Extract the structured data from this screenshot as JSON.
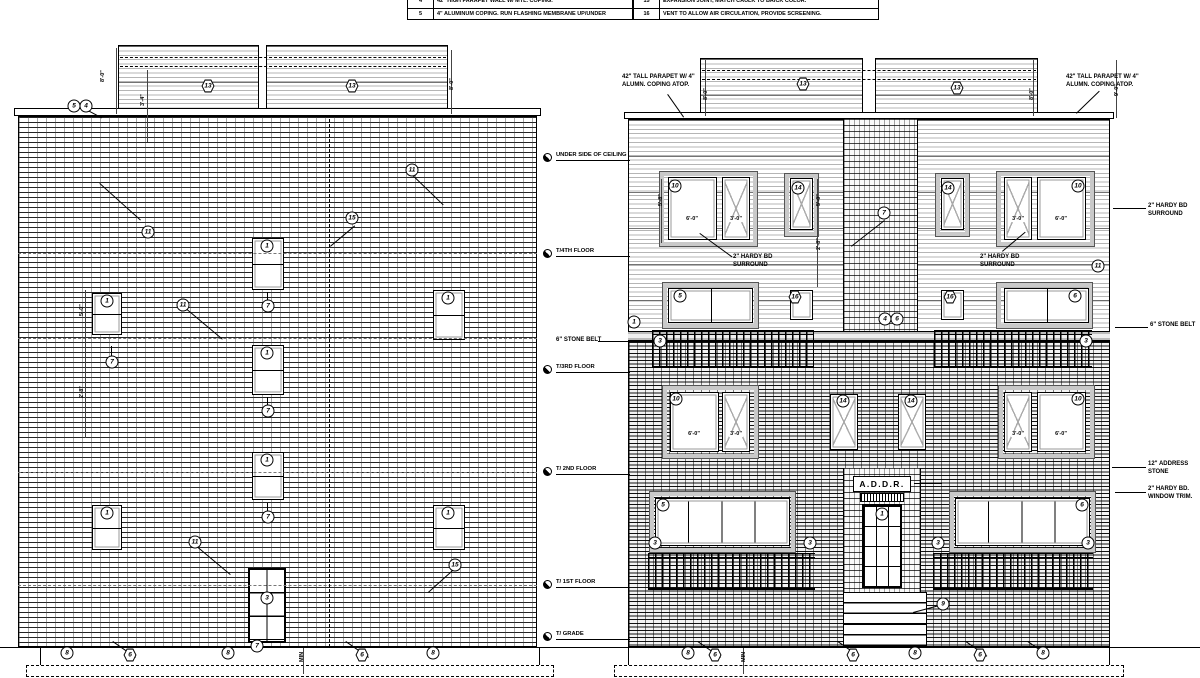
{
  "keynotes": {
    "left": [
      {
        "num": "4",
        "text": "42\" HIGH PARAPET WALL W/ MTL. COPING."
      },
      {
        "num": "5",
        "text": "4\" ALUMINUM COPING. RUN FLASHING MEMBRANE UP/UNDER"
      }
    ],
    "right": [
      {
        "num": "15",
        "text": "EXPANSION JOINT, MATCH CAULK TO BRICK COLOR."
      },
      {
        "num": "16",
        "text": "VENT TO ALLOW AIR CIRCULATION, PROVIDE SCREENING."
      }
    ]
  },
  "sign_text": "A.D.D.R.",
  "boxes": [
    {
      "cls": "siding",
      "x": 118,
      "y": 45,
      "w": 141,
      "h": 68
    },
    {
      "cls": "siding",
      "x": 266,
      "y": 45,
      "w": 182,
      "h": 68
    },
    {
      "cls": "coping",
      "x": 14,
      "y": 108,
      "w": 527,
      "h": 8
    },
    {
      "cls": "brickL",
      "x": 18,
      "y": 116,
      "w": 519,
      "h": 531
    },
    {
      "cls": "door6",
      "x": 248,
      "y": 568,
      "w": 38,
      "h": 75
    },
    {
      "cls": "found",
      "x": 40,
      "y": 647,
      "w": 500,
      "h": 18
    },
    {
      "cls": "foot",
      "x": 26,
      "y": 665,
      "w": 528,
      "h": 12
    },
    {
      "cls": "siding",
      "x": 700,
      "y": 58,
      "w": 163,
      "h": 56
    },
    {
      "cls": "siding",
      "x": 875,
      "y": 58,
      "w": 163,
      "h": 56
    },
    {
      "cls": "coping",
      "x": 624,
      "y": 112,
      "w": 490,
      "h": 7
    },
    {
      "cls": "siding",
      "x": 628,
      "y": 119,
      "w": 482,
      "h": 222
    },
    {
      "cls": "brickC",
      "x": 843,
      "y": 119,
      "w": 75,
      "h": 222
    },
    {
      "cls": "belt",
      "x": 628,
      "y": 331,
      "w": 482,
      "h": 10
    },
    {
      "cls": "brickR",
      "x": 628,
      "y": 341,
      "w": 482,
      "h": 306
    },
    {
      "cls": "surr",
      "x": 660,
      "y": 172,
      "w": 97,
      "h": 74
    },
    {
      "cls": "surr",
      "x": 997,
      "y": 172,
      "w": 97,
      "h": 74
    },
    {
      "cls": "surr",
      "x": 785,
      "y": 174,
      "w": 33,
      "h": 62
    },
    {
      "cls": "surr",
      "x": 936,
      "y": 174,
      "w": 33,
      "h": 62
    },
    {
      "cls": "surr",
      "x": 663,
      "y": 283,
      "w": 95,
      "h": 45
    },
    {
      "cls": "surr",
      "x": 997,
      "y": 283,
      "w": 95,
      "h": 45
    },
    {
      "cls": "rail",
      "x": 652,
      "y": 330,
      "w": 162,
      "h": 38
    },
    {
      "cls": "rail",
      "x": 934,
      "y": 330,
      "w": 158,
      "h": 38
    },
    {
      "cls": "surr",
      "x": 663,
      "y": 386,
      "w": 95,
      "h": 72
    },
    {
      "cls": "surr",
      "x": 999,
      "y": 386,
      "w": 95,
      "h": 72
    },
    {
      "cls": "surr",
      "x": 650,
      "y": 492,
      "w": 145,
      "h": 60
    },
    {
      "cls": "surr",
      "x": 950,
      "y": 492,
      "w": 145,
      "h": 60
    },
    {
      "cls": "brickC",
      "x": 843,
      "y": 468,
      "w": 78,
      "h": 124
    },
    {
      "cls": "signbox",
      "x": 853,
      "y": 476,
      "w": 58,
      "h": 16
    },
    {
      "cls": "vent",
      "x": 860,
      "y": 493,
      "w": 44,
      "h": 9
    },
    {
      "cls": "doorGlass",
      "x": 862,
      "y": 504,
      "w": 40,
      "h": 84
    },
    {
      "cls": "rail",
      "x": 648,
      "y": 553,
      "w": 167,
      "h": 37
    },
    {
      "cls": "rail",
      "x": 933,
      "y": 553,
      "w": 160,
      "h": 37
    },
    {
      "cls": "stairs",
      "x": 843,
      "y": 592,
      "w": 84,
      "h": 54
    },
    {
      "cls": "found",
      "x": 628,
      "y": 647,
      "w": 482,
      "h": 18
    },
    {
      "cls": "foot",
      "x": 614,
      "y": 665,
      "w": 510,
      "h": 12
    }
  ],
  "windows": [
    {
      "cls": "dh",
      "x": 92,
      "y": 293,
      "w": 30,
      "h": 42
    },
    {
      "cls": "dh",
      "x": 92,
      "y": 505,
      "w": 30,
      "h": 45
    },
    {
      "cls": "dh",
      "x": 252,
      "y": 238,
      "w": 32,
      "h": 52
    },
    {
      "cls": "dh",
      "x": 252,
      "y": 345,
      "w": 32,
      "h": 50
    },
    {
      "cls": "dh",
      "x": 252,
      "y": 452,
      "w": 32,
      "h": 48
    },
    {
      "cls": "dh",
      "x": 433,
      "y": 290,
      "w": 32,
      "h": 50
    },
    {
      "cls": "dh",
      "x": 433,
      "y": 505,
      "w": 32,
      "h": 45
    },
    {
      "cls": "fx",
      "x": 668,
      "y": 177,
      "w": 49,
      "h": 63
    },
    {
      "cls": "cs",
      "x": 722,
      "y": 177,
      "w": 28,
      "h": 63
    },
    {
      "cls": "cs",
      "x": 790,
      "y": 178,
      "w": 23,
      "h": 52
    },
    {
      "cls": "cs",
      "x": 941,
      "y": 178,
      "w": 23,
      "h": 52
    },
    {
      "cls": "cs",
      "x": 1004,
      "y": 177,
      "w": 28,
      "h": 63
    },
    {
      "cls": "fx",
      "x": 1037,
      "y": 177,
      "w": 49,
      "h": 63
    },
    {
      "cls": "t2",
      "x": 668,
      "y": 288,
      "w": 85,
      "h": 35
    },
    {
      "cls": "fx",
      "x": 790,
      "y": 290,
      "w": 23,
      "h": 30
    },
    {
      "cls": "fx",
      "x": 941,
      "y": 290,
      "w": 23,
      "h": 30
    },
    {
      "cls": "t2",
      "x": 1004,
      "y": 288,
      "w": 85,
      "h": 35
    },
    {
      "cls": "fx",
      "x": 670,
      "y": 392,
      "w": 49,
      "h": 60
    },
    {
      "cls": "cs",
      "x": 722,
      "y": 392,
      "w": 28,
      "h": 60
    },
    {
      "cls": "cs",
      "x": 830,
      "y": 394,
      "w": 28,
      "h": 56
    },
    {
      "cls": "cs",
      "x": 898,
      "y": 394,
      "w": 28,
      "h": 56
    },
    {
      "cls": "cs",
      "x": 1004,
      "y": 392,
      "w": 28,
      "h": 60
    },
    {
      "cls": "fx",
      "x": 1037,
      "y": 392,
      "w": 49,
      "h": 60
    },
    {
      "cls": "t4",
      "x": 655,
      "y": 498,
      "w": 135,
      "h": 48
    },
    {
      "cls": "t4",
      "x": 955,
      "y": 498,
      "w": 135,
      "h": 48
    }
  ],
  "tags": [
    {
      "x": 74,
      "y": 106,
      "n": "5"
    },
    {
      "x": 86,
      "y": 106,
      "n": "4"
    },
    {
      "x": 208,
      "y": 86,
      "n": "13",
      "cls": "hex"
    },
    {
      "x": 352,
      "y": 86,
      "n": "13",
      "cls": "hex"
    },
    {
      "x": 107,
      "y": 301,
      "n": "1"
    },
    {
      "x": 107,
      "y": 513,
      "n": "1"
    },
    {
      "x": 267,
      "y": 246,
      "n": "1"
    },
    {
      "x": 267,
      "y": 353,
      "n": "1"
    },
    {
      "x": 267,
      "y": 460,
      "n": "1"
    },
    {
      "x": 448,
      "y": 298,
      "n": "1"
    },
    {
      "x": 448,
      "y": 513,
      "n": "1"
    },
    {
      "x": 112,
      "y": 362,
      "n": "7"
    },
    {
      "x": 268,
      "y": 306,
      "n": "7"
    },
    {
      "x": 268,
      "y": 411,
      "n": "7"
    },
    {
      "x": 268,
      "y": 517,
      "n": "7"
    },
    {
      "x": 148,
      "y": 232,
      "n": "11"
    },
    {
      "x": 183,
      "y": 305,
      "n": "11"
    },
    {
      "x": 412,
      "y": 170,
      "n": "11"
    },
    {
      "x": 352,
      "y": 218,
      "n": "15"
    },
    {
      "x": 195,
      "y": 542,
      "n": "11"
    },
    {
      "x": 455,
      "y": 565,
      "n": "15"
    },
    {
      "x": 267,
      "y": 598,
      "n": "3"
    },
    {
      "x": 67,
      "y": 653,
      "n": "8"
    },
    {
      "x": 130,
      "y": 655,
      "n": "6",
      "cls": "hex"
    },
    {
      "x": 228,
      "y": 653,
      "n": "8"
    },
    {
      "x": 257,
      "y": 646,
      "n": "7"
    },
    {
      "x": 362,
      "y": 655,
      "n": "6",
      "cls": "hex"
    },
    {
      "x": 433,
      "y": 653,
      "n": "8"
    },
    {
      "x": 803,
      "y": 84,
      "n": "13",
      "cls": "hex"
    },
    {
      "x": 957,
      "y": 88,
      "n": "13",
      "cls": "hex"
    },
    {
      "x": 675,
      "y": 186,
      "n": "10"
    },
    {
      "x": 1078,
      "y": 186,
      "n": "10"
    },
    {
      "x": 798,
      "y": 188,
      "n": "14"
    },
    {
      "x": 948,
      "y": 188,
      "n": "14"
    },
    {
      "x": 884,
      "y": 213,
      "n": "7"
    },
    {
      "x": 680,
      "y": 296,
      "n": "5"
    },
    {
      "x": 1075,
      "y": 296,
      "n": "6"
    },
    {
      "x": 795,
      "y": 297,
      "n": "16",
      "cls": "hex"
    },
    {
      "x": 950,
      "y": 297,
      "n": "16",
      "cls": "hex"
    },
    {
      "x": 885,
      "y": 319,
      "n": "4"
    },
    {
      "x": 897,
      "y": 319,
      "n": "6"
    },
    {
      "x": 634,
      "y": 322,
      "n": "1"
    },
    {
      "x": 660,
      "y": 341,
      "n": "3"
    },
    {
      "x": 1086,
      "y": 341,
      "n": "3"
    },
    {
      "x": 676,
      "y": 399,
      "n": "10"
    },
    {
      "x": 1078,
      "y": 399,
      "n": "10"
    },
    {
      "x": 843,
      "y": 401,
      "n": "14"
    },
    {
      "x": 911,
      "y": 401,
      "n": "14"
    },
    {
      "x": 663,
      "y": 505,
      "n": "5"
    },
    {
      "x": 1082,
      "y": 505,
      "n": "6"
    },
    {
      "x": 655,
      "y": 543,
      "n": "3"
    },
    {
      "x": 810,
      "y": 543,
      "n": "3"
    },
    {
      "x": 938,
      "y": 543,
      "n": "3"
    },
    {
      "x": 1088,
      "y": 543,
      "n": "3"
    },
    {
      "x": 882,
      "y": 514,
      "n": "1"
    },
    {
      "x": 943,
      "y": 604,
      "n": "9"
    },
    {
      "x": 1098,
      "y": 266,
      "n": "11"
    },
    {
      "x": 688,
      "y": 653,
      "n": "8"
    },
    {
      "x": 715,
      "y": 655,
      "n": "6",
      "cls": "hex"
    },
    {
      "x": 853,
      "y": 655,
      "n": "6",
      "cls": "hex"
    },
    {
      "x": 915,
      "y": 653,
      "n": "8"
    },
    {
      "x": 980,
      "y": 655,
      "n": "6",
      "cls": "hex"
    },
    {
      "x": 1043,
      "y": 653,
      "n": "8"
    }
  ],
  "texts": [
    {
      "x": 622,
      "y": 74,
      "t": "42\" TALL PARAPET W/ 4\""
    },
    {
      "x": 622,
      "y": 82,
      "t": "ALUMN. COPING ATOP."
    },
    {
      "x": 1066,
      "y": 74,
      "t": "42\" TALL PARAPET W/ 4\""
    },
    {
      "x": 1066,
      "y": 82,
      "t": "ALUMN. COPING ATOP."
    },
    {
      "x": 733,
      "y": 254,
      "t": "2\" HARDY BD"
    },
    {
      "x": 733,
      "y": 262,
      "t": "SURROUND"
    },
    {
      "x": 980,
      "y": 254,
      "t": "2\" HARDY BD"
    },
    {
      "x": 980,
      "y": 262,
      "t": "SURROUND"
    },
    {
      "x": 556,
      "y": 337,
      "t": "6\" STONE BELT"
    },
    {
      "x": 1148,
      "y": 203,
      "t": "2\" HARDY BD"
    },
    {
      "x": 1148,
      "y": 211,
      "t": "SURROUND"
    },
    {
      "x": 1150,
      "y": 322,
      "t": "6\" STONE BELT"
    },
    {
      "x": 1148,
      "y": 461,
      "t": "12\" ADDRESS"
    },
    {
      "x": 1148,
      "y": 469,
      "t": "STONE"
    },
    {
      "x": 1148,
      "y": 486,
      "t": "2\" HARDY BD."
    },
    {
      "x": 1148,
      "y": 494,
      "t": "WINDOW TRIM."
    },
    {
      "x": 882,
      "y": 479,
      "t": "A.D.D.R.",
      "cls": "sign"
    },
    {
      "x": 692,
      "y": 216,
      "t": "6'-0\"",
      "cls": "dim"
    },
    {
      "x": 736,
      "y": 216,
      "t": "3'-0\"",
      "cls": "dim"
    },
    {
      "x": 1018,
      "y": 216,
      "t": "3'-0\"",
      "cls": "dim"
    },
    {
      "x": 1061,
      "y": 216,
      "t": "6'-0\"",
      "cls": "dim"
    },
    {
      "x": 694,
      "y": 431,
      "t": "6'-0\"",
      "cls": "dim"
    },
    {
      "x": 736,
      "y": 431,
      "t": "3'-0\"",
      "cls": "dim"
    },
    {
      "x": 1018,
      "y": 431,
      "t": "3'-0\"",
      "cls": "dim"
    },
    {
      "x": 1061,
      "y": 431,
      "t": "6'-0\"",
      "cls": "dim"
    },
    {
      "x": 100,
      "y": 82,
      "t": "8'-0\"",
      "cls": "rot"
    },
    {
      "x": 140,
      "y": 106,
      "t": "3'-4\"",
      "cls": "rot"
    },
    {
      "x": 449,
      "y": 90,
      "t": "8'-0\"",
      "cls": "rot"
    },
    {
      "x": 703,
      "y": 100,
      "t": "8'-0\"",
      "cls": "rot"
    },
    {
      "x": 1029,
      "y": 100,
      "t": "8'-0\"",
      "cls": "rot"
    },
    {
      "x": 1114,
      "y": 96,
      "t": "9'-0\"",
      "cls": "rot"
    },
    {
      "x": 79,
      "y": 316,
      "t": "5'-0\"",
      "cls": "rot"
    },
    {
      "x": 79,
      "y": 398,
      "t": "2'-8\"",
      "cls": "rot"
    },
    {
      "x": 816,
      "y": 206,
      "t": "5'-0\"",
      "cls": "rot"
    },
    {
      "x": 816,
      "y": 250,
      "t": "2'-8\"",
      "cls": "rot"
    },
    {
      "x": 658,
      "y": 206,
      "t": "5'-8\"",
      "cls": "rot"
    },
    {
      "x": 299,
      "y": 662,
      "t": "MIN",
      "cls": "rot"
    },
    {
      "x": 741,
      "y": 662,
      "t": "MIN",
      "cls": "rot"
    }
  ],
  "levels": [
    {
      "x": 556,
      "y": 152,
      "l1": "UNDER SIDE OF CEILING",
      "l2": "EL. +47'-9\""
    },
    {
      "x": 556,
      "y": 248,
      "l1": "T/4TH FLOOR",
      "l2": "EL. +38'-0\""
    },
    {
      "x": 556,
      "y": 364,
      "l1": "T/3RD FLOOR",
      "l2": "EL. +27'-0\""
    },
    {
      "x": 556,
      "y": 466,
      "l1": "T/ 2ND FLOOR",
      "l2": "EL. +18'-8\""
    },
    {
      "x": 556,
      "y": 579,
      "l1": "T/ 1ST FLOOR",
      "l2": "EL. +10'-4\""
    },
    {
      "x": 556,
      "y": 631,
      "l1": "T/ GRADE",
      "l2": "EL. 0'-0\""
    }
  ],
  "lines": [
    {
      "x": 120,
      "y": 57,
      "w": 326,
      "ang": 0,
      "cls": "dd"
    },
    {
      "x": 120,
      "y": 66,
      "w": 326,
      "ang": 0,
      "cls": "dd"
    },
    {
      "x": 702,
      "y": 70,
      "w": 334,
      "ang": 0,
      "cls": "dd"
    },
    {
      "x": 702,
      "y": 79,
      "w": 334,
      "ang": 0,
      "cls": "dd"
    },
    {
      "x": 18,
      "y": 253,
      "w": 519,
      "ang": 0,
      "cls": "dd2"
    },
    {
      "x": 18,
      "y": 338,
      "w": 519,
      "ang": 0,
      "cls": "dd2"
    },
    {
      "x": 18,
      "y": 472,
      "w": 519,
      "ang": 0,
      "cls": "dd2"
    },
    {
      "x": 18,
      "y": 585,
      "w": 519,
      "ang": 0,
      "cls": "dd2"
    },
    {
      "x": 330,
      "y": 119,
      "w": 528,
      "ang": 90,
      "cls": "dd"
    },
    {
      "x": 88,
      "y": 110,
      "w": 16,
      "ang": 28
    },
    {
      "x": 100,
      "y": 183,
      "w": 55,
      "ang": 42
    },
    {
      "x": 186,
      "y": 308,
      "w": 48,
      "ang": 40
    },
    {
      "x": 330,
      "y": 246,
      "w": 32,
      "ang": -40
    },
    {
      "x": 197,
      "y": 546,
      "w": 44,
      "ang": 40
    },
    {
      "x": 428,
      "y": 592,
      "w": 34,
      "ang": -42
    },
    {
      "x": 412,
      "y": 174,
      "w": 44,
      "ang": 44
    },
    {
      "x": 112,
      "y": 346,
      "w": 12,
      "ang": 90
    },
    {
      "x": 268,
      "y": 292,
      "w": 10,
      "ang": 90
    },
    {
      "x": 268,
      "y": 397,
      "w": 10,
      "ang": 90
    },
    {
      "x": 268,
      "y": 503,
      "w": 10,
      "ang": 90
    },
    {
      "x": 700,
      "y": 233,
      "w": 40,
      "ang": 36
    },
    {
      "x": 1002,
      "y": 251,
      "w": 30,
      "ang": -40
    },
    {
      "x": 851,
      "y": 246,
      "w": 42,
      "ang": -38
    },
    {
      "x": 913,
      "y": 612,
      "w": 31,
      "ang": -15
    },
    {
      "x": 914,
      "y": 483,
      "w": 28,
      "ang": 0
    },
    {
      "x": 1113,
      "y": 208,
      "w": 33,
      "ang": 0
    },
    {
      "x": 1115,
      "y": 327,
      "w": 33,
      "ang": 0
    },
    {
      "x": 1112,
      "y": 467,
      "w": 34,
      "ang": 0
    },
    {
      "x": 1115,
      "y": 492,
      "w": 31,
      "ang": 0
    },
    {
      "x": 598,
      "y": 341,
      "w": 30,
      "ang": 0
    },
    {
      "x": 668,
      "y": 94,
      "w": 28,
      "ang": 55
    },
    {
      "x": 1076,
      "y": 113,
      "w": 32,
      "ang": -44
    },
    {
      "x": 113,
      "y": 641,
      "w": 28,
      "ang": 35
    },
    {
      "x": 346,
      "y": 641,
      "w": 28,
      "ang": 35
    },
    {
      "x": 698,
      "y": 641,
      "w": 28,
      "ang": 35
    },
    {
      "x": 838,
      "y": 641,
      "w": 26,
      "ang": 35
    },
    {
      "x": 966,
      "y": 641,
      "w": 26,
      "ang": 35
    },
    {
      "x": 1028,
      "y": 641,
      "w": 26,
      "ang": 35
    },
    {
      "x": 0,
      "y": 647,
      "w": 1200,
      "ang": 0,
      "cls": "grade"
    },
    {
      "x": 86,
      "y": 290,
      "w": 148,
      "ang": 90,
      "cls": "thin"
    },
    {
      "x": 818,
      "y": 179,
      "w": 108,
      "ang": 90,
      "cls": "thin"
    },
    {
      "x": 662,
      "y": 179,
      "w": 64,
      "ang": 90,
      "cls": "thin"
    },
    {
      "x": 706,
      "y": 60,
      "w": 56,
      "ang": 90,
      "cls": "thin"
    },
    {
      "x": 1034,
      "y": 60,
      "w": 56,
      "ang": 90,
      "cls": "thin"
    },
    {
      "x": 117,
      "y": 48,
      "w": 66,
      "ang": 90,
      "cls": "thin"
    },
    {
      "x": 148,
      "y": 70,
      "w": 72,
      "ang": 90,
      "cls": "thin"
    },
    {
      "x": 452,
      "y": 50,
      "w": 64,
      "ang": 90,
      "cls": "thin"
    },
    {
      "x": 1117,
      "y": 60,
      "w": 58,
      "ang": 90,
      "cls": "thin"
    },
    {
      "x": 304,
      "y": 648,
      "w": 26,
      "ang": 90,
      "cls": "thin"
    },
    {
      "x": 744,
      "y": 648,
      "w": 26,
      "ang": 90,
      "cls": "thin"
    }
  ]
}
